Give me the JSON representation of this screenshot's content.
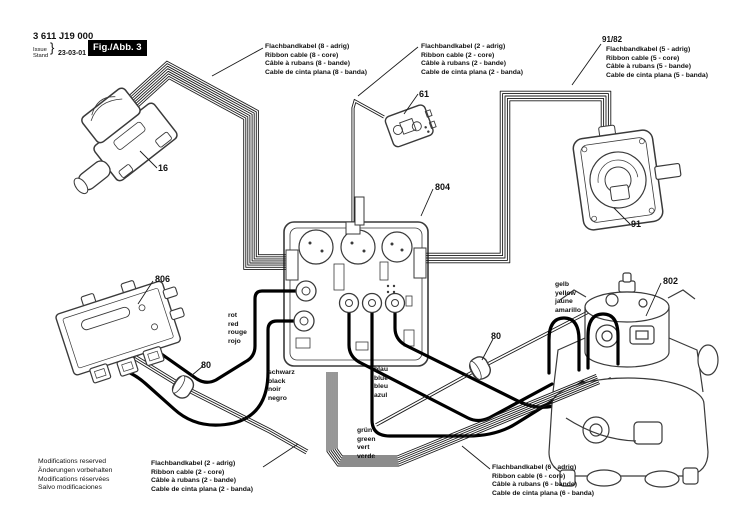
{
  "header": {
    "part_number": "3 611 J19 000",
    "issue_label": "Issue",
    "stand_label": "Stand",
    "date": "23-03-01",
    "figure_label": "Fig./Abb. 3"
  },
  "cable_labels": {
    "ribbon8": {
      "lines": [
        "Flachbandkabel (8 - adrig)",
        "Ribbon cable (8 - core)",
        "Câble à rubans (8 - bande)",
        "Cable de cinta plana (8 - banda)"
      ]
    },
    "ribbon2_top": {
      "lines": [
        "Flachbandkabel (2 - adrig)",
        "Ribbon cable (2 - core)",
        "Câble à rubans (2 - bande)",
        "Cable de cinta plana (2 - banda)"
      ]
    },
    "ribbon5": {
      "part_ref": "91/82",
      "lines": [
        "Flachbandkabel (5 - adrig)",
        "Ribbon cable (5 - core)",
        "Câble à rubans (5 - bande)",
        "Cable de cinta plana (5 - banda)"
      ]
    },
    "ribbon2_bottom": {
      "lines": [
        "Flachbandkabel (2 - adrig)",
        "Ribbon cable (2 - core)",
        "Câble à rubans (2 - bande)",
        "Cable de cinta plana (2 - banda)"
      ]
    },
    "ribbon6": {
      "lines": [
        "Flachbandkabel (6 - adrig)",
        "Ribbon cable (6 - core)",
        "Câble à rubans (6 - bande)",
        "Cable de cinta plana (6 - banda)"
      ]
    }
  },
  "wire_colors": {
    "red": {
      "lines": [
        "rot",
        "red",
        "rouge",
        "rojo"
      ]
    },
    "black": {
      "lines": [
        "schwarz",
        "black",
        "noir",
        "negro"
      ]
    },
    "blue": {
      "lines": [
        "blau",
        "blue",
        "bleu",
        "azul"
      ]
    },
    "green": {
      "lines": [
        "grün",
        "green",
        "vert",
        "verde"
      ]
    },
    "yellow": {
      "lines": [
        "gelb",
        "yellow",
        "jaune",
        "amarillo"
      ]
    }
  },
  "part_callouts": {
    "switch": "16",
    "module": "61",
    "receiver": "91",
    "motor": "802",
    "pcb": "804",
    "plate": "806",
    "ferrite_left": "80",
    "ferrite_right": "80"
  },
  "footer": {
    "lines": [
      "Modifications reserved",
      "Änderungen vorbehalten",
      "Modifications réservées",
      "Salvo modificaciones"
    ]
  },
  "colors": {
    "ink": "#1a1a1a",
    "component_ink": "#3a3a3a",
    "background": "#ffffff",
    "figure_badge_bg": "#000000",
    "figure_badge_fg": "#ffffff"
  }
}
